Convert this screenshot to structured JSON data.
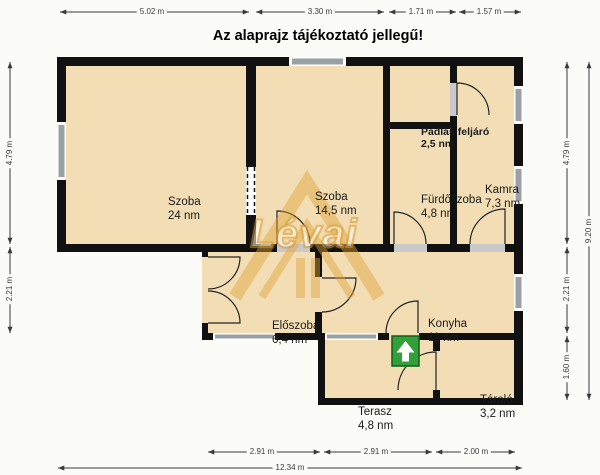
{
  "title": "Az alaprajz tájékoztató jellegű!",
  "watermark": {
    "text": "Lévai"
  },
  "entrance": {
    "icon": "up-arrow",
    "color": "#31a03a"
  },
  "colors": {
    "floor": "#f2ddb5",
    "wall": "#111111",
    "window": "#9aa0a4",
    "dimension": "#3a3a3a",
    "watermark": "#d89a30",
    "background": "#fbfbf8"
  },
  "rooms": [
    {
      "name": "Szoba",
      "area": "24 nm"
    },
    {
      "name": "Szoba",
      "area": "14,5 nm"
    },
    {
      "name": "Padlás feljáró",
      "area": "2,5 nm"
    },
    {
      "name": "Fürdőszoba",
      "area": "4,8 nm"
    },
    {
      "name": "Kamra",
      "area": "7,3 nm"
    },
    {
      "name": "Előszoba",
      "area": "6,4 nm"
    },
    {
      "name": "Konyha",
      "area": "11 nm"
    },
    {
      "name": "Terasz",
      "area": "4,8 nm"
    },
    {
      "name": "Tároló",
      "area": "3,2 nm"
    }
  ],
  "dimensions": {
    "top": [
      "5.02 m",
      "3.30 m",
      "1.71 m",
      "1.57 m"
    ],
    "left": [
      "4.79 m",
      "2.21 m"
    ],
    "right": [
      "4.79 m",
      "2.21 m",
      "1.60 m"
    ],
    "right_total": "9.20 m",
    "bottom": [
      "2.91 m",
      "2.91 m",
      "2.00 m"
    ],
    "bottom_total": "12.34 m"
  }
}
